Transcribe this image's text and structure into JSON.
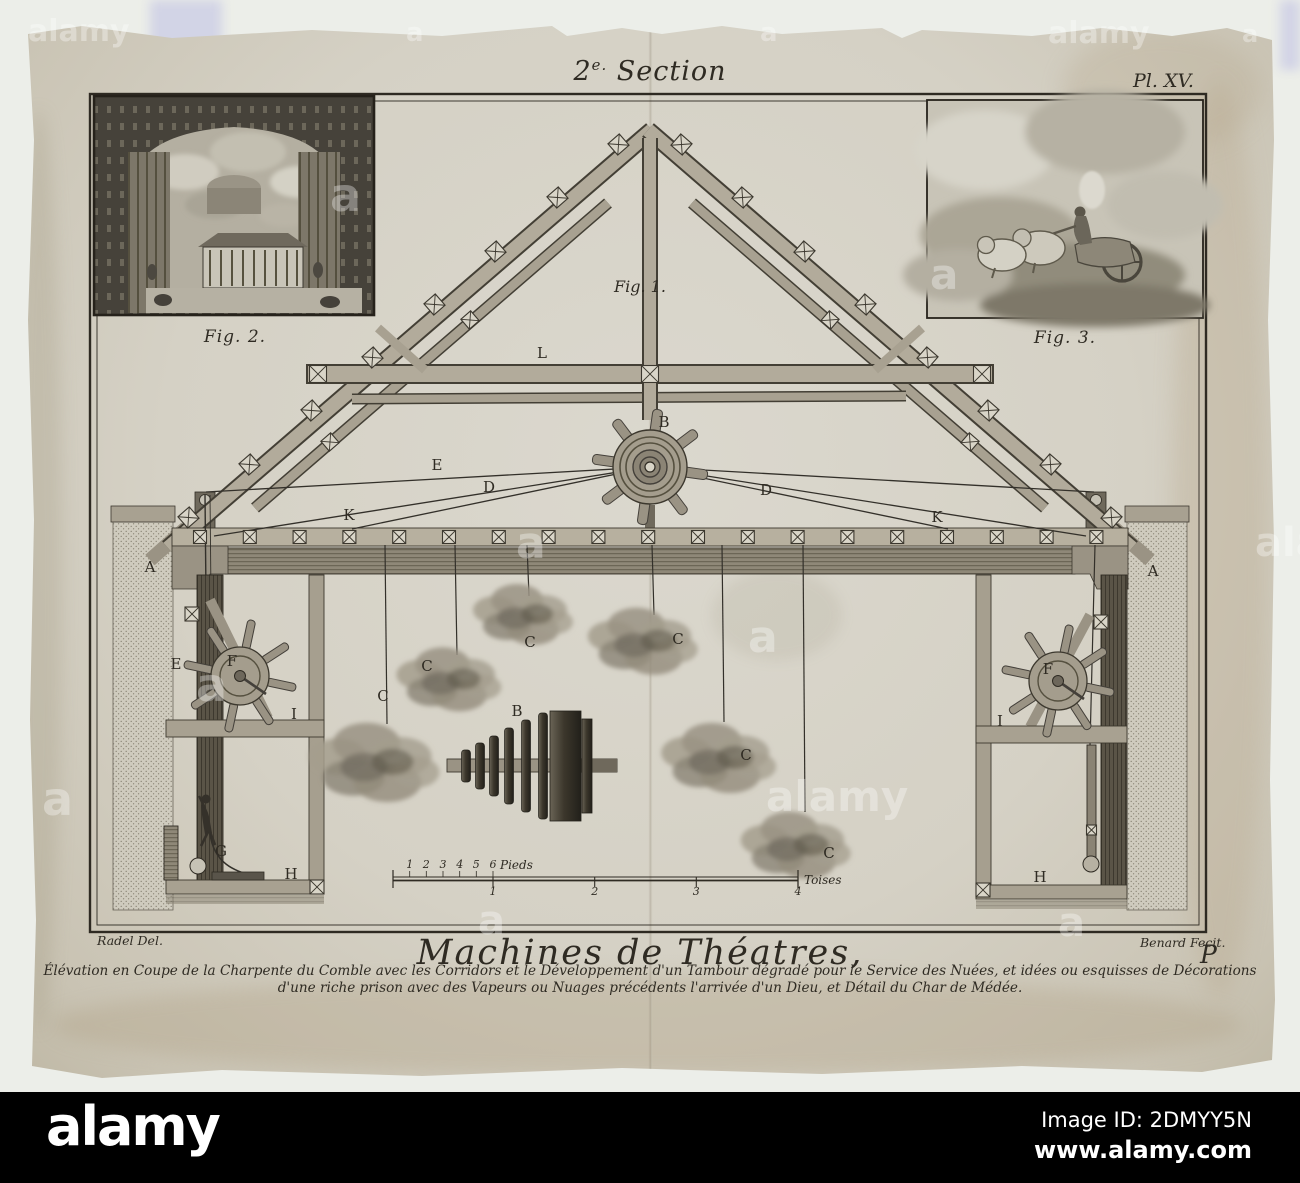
{
  "plate": {
    "section_title": {
      "num": "2",
      "sup": "e.",
      "word": "Section"
    },
    "plate_number": "Pl. XV.",
    "fig1_label": "Fig. 1.",
    "fig2_caption": "Fig. 2.",
    "fig3_caption": "Fig. 3.",
    "title": "Machines de Théatres,",
    "caption_line1": "Élévation en Coupe de la Charpente du Comble avec les Corridors et le Développement d'un Tambour dégradé pour le Service des Nuées, et idées ou esquisses de Décorations",
    "caption_line2": "d'une riche prison avec des Vapeurs ou Nuages précédents l'arrivée d'un Dieu, et Détail du Char de Médée.",
    "credit_left": "Radel Del.",
    "credit_right": "Benard Fecit.",
    "page_letter": "P"
  },
  "diagram_labels": [
    {
      "text": "A",
      "x": 150,
      "y": 572
    },
    {
      "text": "A",
      "x": 1153,
      "y": 576
    },
    {
      "text": "B",
      "x": 664,
      "y": 427
    },
    {
      "text": "B",
      "x": 517,
      "y": 716
    },
    {
      "text": "C",
      "x": 530,
      "y": 647
    },
    {
      "text": "C",
      "x": 427,
      "y": 671
    },
    {
      "text": "C",
      "x": 383,
      "y": 701
    },
    {
      "text": "C",
      "x": 678,
      "y": 644
    },
    {
      "text": "C",
      "x": 746,
      "y": 760
    },
    {
      "text": "C",
      "x": 829,
      "y": 858
    },
    {
      "text": "D",
      "x": 489,
      "y": 492
    },
    {
      "text": "D",
      "x": 766,
      "y": 495
    },
    {
      "text": "E",
      "x": 437,
      "y": 470
    },
    {
      "text": "E",
      "x": 176,
      "y": 669
    },
    {
      "text": "F",
      "x": 232,
      "y": 666
    },
    {
      "text": "F",
      "x": 1048,
      "y": 674
    },
    {
      "text": "G",
      "x": 221,
      "y": 856
    },
    {
      "text": "H",
      "x": 291,
      "y": 879
    },
    {
      "text": "H",
      "x": 1040,
      "y": 882
    },
    {
      "text": "I",
      "x": 294,
      "y": 719
    },
    {
      "text": "I",
      "x": 1000,
      "y": 726
    },
    {
      "text": "K",
      "x": 349,
      "y": 520
    },
    {
      "text": "K",
      "x": 937,
      "y": 522
    },
    {
      "text": "L",
      "x": 542,
      "y": 358
    }
  ],
  "scale_bar": {
    "pieds_numbers": [
      "1",
      "2",
      "3",
      "4",
      "5",
      "6"
    ],
    "pieds_unit": "Pieds",
    "toise_numbers": [
      "1",
      "2",
      "3",
      "4"
    ],
    "toise_unit": "Toises"
  },
  "watermark": {
    "logo_text": "alamy",
    "letter": "a"
  },
  "footer": {
    "logo": "alamy",
    "image_id": "Image ID: 2DMYY5N",
    "url": "www.alamy.com"
  },
  "colors": {
    "background": "#eceee9",
    "paper": "#d5d1c5",
    "ink": "#2f2b23",
    "footer_bar": "#000000"
  }
}
